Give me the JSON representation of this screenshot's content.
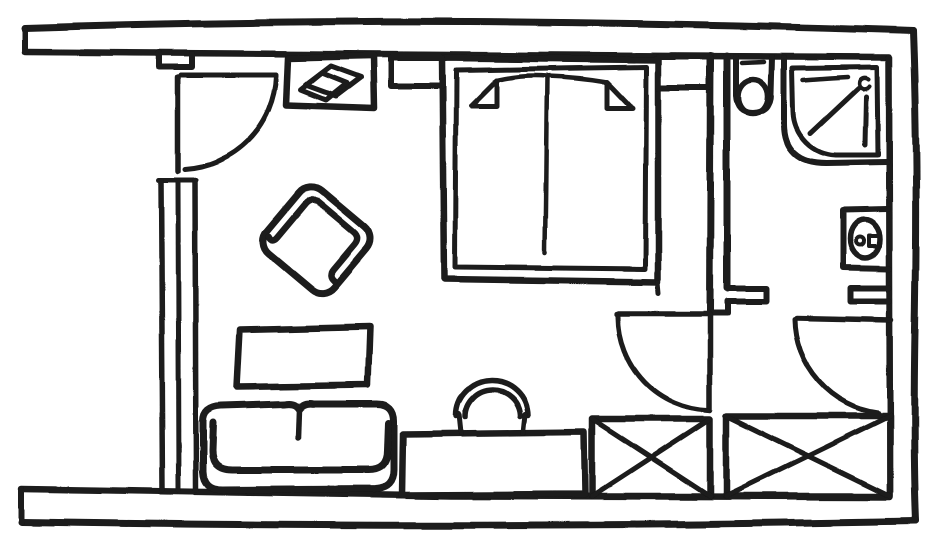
{
  "meta": {
    "description": "hand-drawn hotel room floor plan, black marker on white",
    "background": "#ffffff",
    "ink": "#1a1a1a"
  },
  "canvas": {
    "width": 940,
    "height": 548
  },
  "elements": [
    {
      "name": "top-wall-outer-edge",
      "kind": "path",
      "d": "M25,28 Q240,21 470,22 Q710,24 913,31",
      "sw": 7
    },
    {
      "name": "top-wall-inner-edge",
      "kind": "path",
      "d": "M25,52 L460,55 L888,57",
      "sw": 6.5
    },
    {
      "name": "top-wall-left-cap",
      "kind": "line",
      "x1": 25,
      "y1": 28,
      "x2": 25,
      "y2": 52,
      "sw": 6
    },
    {
      "name": "door-jamb-stub",
      "kind": "path",
      "d": "M159,53 L159,67 L192,67 L192,54",
      "sw": 6
    },
    {
      "name": "right-wall-outer-edge",
      "kind": "path",
      "d": "M913,31 Q918,160 915,330 Q913,450 916,521",
      "sw": 7
    },
    {
      "name": "right-wall-inner-edge",
      "kind": "path",
      "d": "M889,57 L890,497",
      "sw": 6.5
    },
    {
      "name": "bottom-wall-inner-edge",
      "kind": "path",
      "d": "M22,489 L450,496 L889,497",
      "sw": 6.5
    },
    {
      "name": "bottom-wall-outer-edge",
      "kind": "path",
      "d": "M22,522 Q470,529 916,521",
      "sw": 7
    },
    {
      "name": "bottom-wall-left-cap",
      "kind": "line",
      "x1": 22,
      "y1": 489,
      "x2": 22,
      "y2": 522,
      "sw": 6
    },
    {
      "name": "bathroom-wall-left-line",
      "kind": "path",
      "d": "M711,56 L710,313",
      "sw": 7
    },
    {
      "name": "bathroom-wall-right-line",
      "kind": "path",
      "d": "M727,56 L727,288",
      "sw": 7
    },
    {
      "name": "bathroom-wall-foot",
      "kind": "path",
      "d": "M727,288 L766,288 L766,301 L727,301 L727,313 L711,313",
      "sw": 6
    },
    {
      "name": "bathroom-wall-right-stub",
      "kind": "path",
      "d": "M889,288 L851,288 L851,301 L889,301",
      "sw": 6
    },
    {
      "name": "window-top-cap",
      "kind": "line",
      "x1": 159,
      "y1": 180,
      "x2": 196,
      "y2": 180,
      "sw": 5
    },
    {
      "name": "window-outer-line",
      "kind": "line",
      "x1": 161,
      "y1": 181,
      "x2": 163,
      "y2": 490,
      "sw": 5.5
    },
    {
      "name": "window-middle-line",
      "kind": "line",
      "x1": 178,
      "y1": 181,
      "x2": 179,
      "y2": 490,
      "sw": 5
    },
    {
      "name": "window-inner-line",
      "kind": "line",
      "x1": 195,
      "y1": 181,
      "x2": 196,
      "y2": 490,
      "sw": 5.5
    },
    {
      "name": "entrance-door-opening-line",
      "kind": "line",
      "x1": 181,
      "y1": 75,
      "x2": 276,
      "y2": 75,
      "sw": 5
    },
    {
      "name": "entrance-door-leaf",
      "kind": "line",
      "x1": 178,
      "y1": 77,
      "x2": 178,
      "y2": 171,
      "sw": 5.5
    },
    {
      "name": "entrance-door-swing-arc",
      "kind": "path",
      "d": "M276,76 A97,97 0 0 1 185,169",
      "sw": 5
    },
    {
      "name": "hall-door-opening-line",
      "kind": "line",
      "x1": 617,
      "y1": 314,
      "x2": 709,
      "y2": 314,
      "sw": 5.5
    },
    {
      "name": "hall-door-leaf",
      "kind": "line",
      "x1": 710,
      "y1": 316,
      "x2": 710,
      "y2": 410,
      "sw": 5.5
    },
    {
      "name": "hall-door-swing-arc",
      "kind": "path",
      "d": "M618,317 A94,94 0 0 0 708,410",
      "sw": 5
    },
    {
      "name": "bathroom-door-leaf",
      "kind": "line",
      "x1": 797,
      "y1": 318,
      "x2": 891,
      "y2": 320,
      "sw": 5.5
    },
    {
      "name": "bathroom-door-swing-arc",
      "kind": "path",
      "d": "M795,319 A96,96 0 0 0 878,413",
      "sw": 5
    },
    {
      "name": "bed-outline",
      "kind": "polygon",
      "points": "442,58 658,60 658,282 444,279",
      "sw": 6.5
    },
    {
      "name": "bed-corner-overshoot",
      "kind": "line",
      "x1": 658,
      "y1": 282,
      "x2": 659,
      "y2": 293,
      "sw": 5
    },
    {
      "name": "mattress-outline",
      "kind": "polygon",
      "points": "456,70 646,67 645,269 455,267",
      "sw": 5
    },
    {
      "name": "mattress-divider-line",
      "kind": "line",
      "x1": 547,
      "y1": 76,
      "x2": 545,
      "y2": 253,
      "sw": 4.5
    },
    {
      "name": "pillow-left",
      "kind": "path",
      "d": "M471,106 L497,106 L497,80 Z",
      "sw": 5
    },
    {
      "name": "pillow-right",
      "kind": "path",
      "d": "M607,82 L607,108 L632,108 Z",
      "sw": 5
    },
    {
      "name": "sheet-fold-line",
      "kind": "path",
      "d": "M497,80 Q522,74 547,76 Q578,77 607,82",
      "sw": 4.5
    },
    {
      "name": "nightstand-left",
      "kind": "polygon",
      "points": "391,58 442,58 442,86 391,86",
      "sw": 6
    },
    {
      "name": "nightstand-right",
      "kind": "polygon",
      "points": "658,57 710,57 710,88 658,88",
      "sw": 6
    },
    {
      "name": "wall-shelf",
      "kind": "polygon",
      "points": "288,58 373,56 374,108 286,105",
      "sw": 6.5
    },
    {
      "name": "shelf-object-outer",
      "kind": "polygon",
      "points": "306,85 331,66 361,77 336,96",
      "sw": 5
    },
    {
      "name": "shelf-object-inner",
      "kind": "polygon",
      "points": "301,90 322,73 347,83 326,100",
      "sw": 5
    },
    {
      "name": "armchair-outline",
      "kind": "rect",
      "x": 273,
      "y": 199,
      "width": 88,
      "height": 82,
      "rx": 16,
      "tf": "rotate(40 317 240)",
      "sw": 7
    },
    {
      "name": "armchair-backrest-line",
      "kind": "path",
      "d": "M-39,28 Q-32,31 -32,23 L-32,-21 Q-32,-30 -23,-30 L23,-30 Q32,-30 32,-21 L32,12 Q32,20 40,20",
      "tf": "translate(317 240) rotate(40)",
      "sw": 6.5
    },
    {
      "name": "sofa-outline",
      "kind": "path",
      "d": "M221,406 L285,404 Q295,402 299,409 Q304,402 314,404 L377,404 Q394,404 394,421 L394,470 Q394,488 376,489 L222,490 Q204,490 203,472 L203,422 Q203,407 221,406 Z",
      "sw": 7
    },
    {
      "name": "sofa-cushion-divider",
      "kind": "line",
      "x1": 299,
      "y1": 409,
      "x2": 298,
      "y2": 438,
      "sw": 5.5
    },
    {
      "name": "sofa-seat-line",
      "kind": "path",
      "d": "M213,423 L212,451 Q212,470 232,470 L369,470 Q388,470 388,451 L389,423",
      "sw": 7
    },
    {
      "name": "coffee-table",
      "kind": "polygon",
      "points": "240,330 370,327 368,385 237,387",
      "sw": 6.5
    },
    {
      "name": "desk",
      "kind": "polygon",
      "points": "403,434 584,432 585,494 402,495",
      "sw": 6.5
    },
    {
      "name": "desk-chair-back-outer",
      "kind": "path",
      "d": "M456,416 A36,35 0 0 1 528,415",
      "sw": 5.5
    },
    {
      "name": "desk-chair-back-inner",
      "kind": "path",
      "d": "M465,417 A27,26 0 0 1 520,416",
      "sw": 5.5
    },
    {
      "name": "desk-chair-left-leg",
      "kind": "line",
      "x1": 459,
      "y1": 414,
      "x2": 461,
      "y2": 433,
      "sw": 5
    },
    {
      "name": "desk-chair-right-leg",
      "kind": "line",
      "x1": 525,
      "y1": 414,
      "x2": 523,
      "y2": 433,
      "sw": 5
    },
    {
      "name": "wardrobe-left-box",
      "kind": "polygon",
      "points": "592,419 710,419 710,496 592,496",
      "sw": 6.5
    },
    {
      "name": "wardrobe-left-cross-a",
      "kind": "line",
      "x1": 592,
      "y1": 419,
      "x2": 710,
      "y2": 496,
      "sw": 5
    },
    {
      "name": "wardrobe-left-cross-b",
      "kind": "line",
      "x1": 710,
      "y1": 419,
      "x2": 592,
      "y2": 496,
      "sw": 5
    },
    {
      "name": "wardrobe-right-box",
      "kind": "polygon",
      "points": "726,416 890,416 890,496 726,496",
      "sw": 6.5
    },
    {
      "name": "wardrobe-right-cross-a",
      "kind": "line",
      "x1": 726,
      "y1": 416,
      "x2": 890,
      "y2": 496,
      "sw": 5
    },
    {
      "name": "wardrobe-right-cross-b",
      "kind": "line",
      "x1": 890,
      "y1": 416,
      "x2": 726,
      "y2": 496,
      "sw": 5
    },
    {
      "name": "toilet-outline",
      "kind": "path",
      "d": "M736,57 L736,96 Q737,113 753,113 Q771,112 771,95 L772,57",
      "sw": 6
    },
    {
      "name": "toilet-tank-line",
      "kind": "line",
      "x1": 742,
      "y1": 63,
      "x2": 764,
      "y2": 62,
      "sw": 4.5
    },
    {
      "name": "toilet-bowl",
      "kind": "ellipse",
      "cx": 753,
      "cy": 97,
      "rx": 15,
      "ry": 17,
      "sw": 5.5
    },
    {
      "name": "shower-tray-outer",
      "kind": "path",
      "d": "M784,58 L784,124 Q784,163 826,163 L887,162",
      "sw": 6
    },
    {
      "name": "shower-tray-inner",
      "kind": "path",
      "d": "M792,68 L877,67 L878,155 L836,155 A44,44 0 0 1 793,112 L792,68",
      "sw": 5
    },
    {
      "name": "shower-pipe-line",
      "kind": "path",
      "d": "M803,80 L830,78 L847,77",
      "sw": 4.5
    },
    {
      "name": "shower-head",
      "kind": "path",
      "d": "M868,79 A5.5,5.5 0 1 0 869,86",
      "sw": 4
    },
    {
      "name": "shower-hose-line",
      "kind": "line",
      "x1": 810,
      "y1": 133,
      "x2": 858,
      "y2": 88,
      "sw": 5
    },
    {
      "name": "shower-rail-line",
      "kind": "line",
      "x1": 866,
      "y1": 96,
      "x2": 865,
      "y2": 145,
      "sw": 5
    },
    {
      "name": "sink-counter",
      "kind": "path",
      "d": "M888,209 L843,210 L843,268 L889,269",
      "sw": 6
    },
    {
      "name": "sink-basin",
      "kind": "ellipse",
      "cx": 865,
      "cy": 239,
      "rx": 15,
      "ry": 19,
      "sw": 5.5
    },
    {
      "name": "sink-drain",
      "kind": "circle",
      "cx": 860,
      "cy": 241,
      "r": 4,
      "sw": 4
    },
    {
      "name": "sink-tap",
      "kind": "polygon",
      "points": "869,236 880,236 880,246 869,246",
      "sw": 4
    }
  ]
}
